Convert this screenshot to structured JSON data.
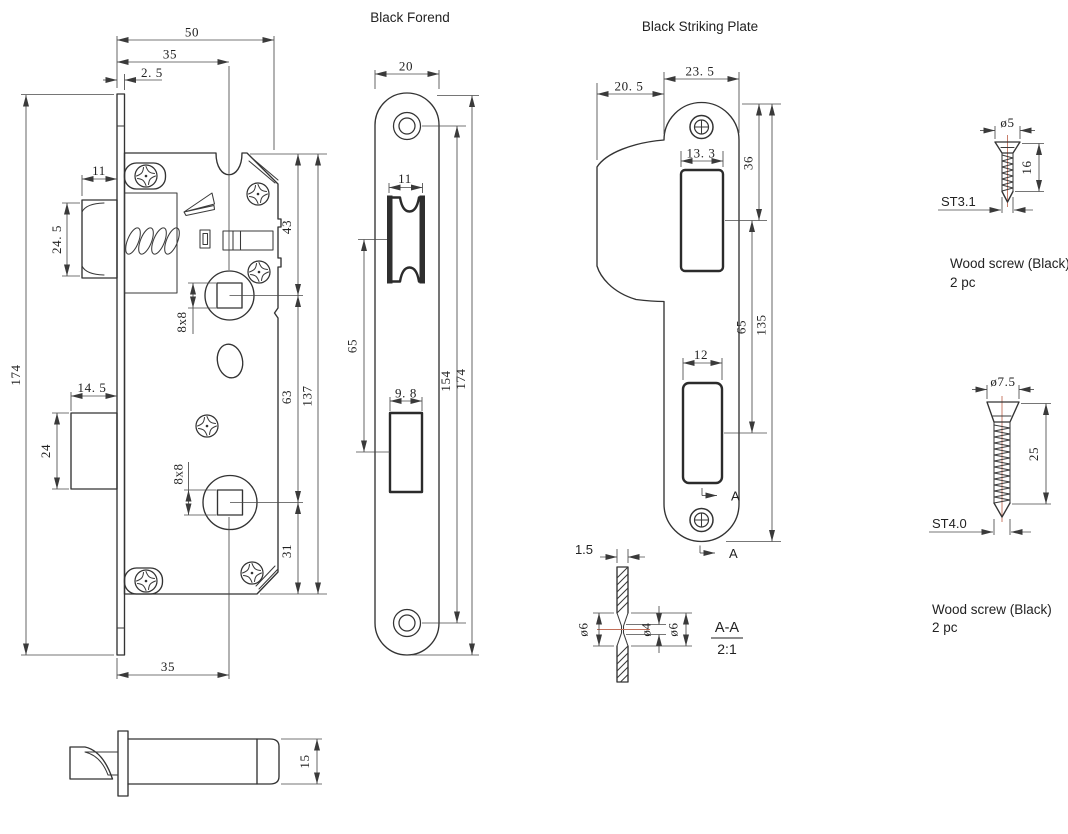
{
  "forend": {
    "title": "Black Forend",
    "dims": {
      "width": "20",
      "latch_cutout": "11",
      "cutout_spacing": "65",
      "bolt_cutout": "9. 8",
      "screw_spacing": "154",
      "length": "174"
    }
  },
  "striking_plate": {
    "title": "Black Striking Plate",
    "dims": {
      "width": "23. 5",
      "lip_width": "20. 5",
      "latch_cutout": "13. 3",
      "top_to_latch": "36",
      "cutout_spacing": "65",
      "length": "135",
      "bolt_cutout": "12"
    },
    "section_marker": "A"
  },
  "lock_body": {
    "dims": {
      "overall_width": "50",
      "backset": "35",
      "faceplate_thickness": "2. 5",
      "latch_width": "11",
      "latch_height": "24. 5",
      "overall_height": "174",
      "bolt_width": "14. 5",
      "bolt_height": "24",
      "spindle_hole": "8x8",
      "cylinder_hole": "8x8",
      "top_to_spindle": "43",
      "spindle_to_cylinder": "63",
      "body_height": "137",
      "cylinder_to_bottom": "31",
      "backset_bottom": "35"
    },
    "latch_detail_height": "15"
  },
  "section": {
    "thickness": "1.5",
    "outer_dia_left": "ø6",
    "inner_dia": "ø4",
    "outer_dia_right": "ø6",
    "label": "A-A",
    "scale": "2:1"
  },
  "screws": {
    "small": {
      "head_dia": "ø5",
      "length": "16",
      "thread": "ST3.1",
      "caption": "Wood screw (Black)",
      "qty": "2 pc"
    },
    "large": {
      "head_dia": "ø7.5",
      "length": "25",
      "thread": "ST4.0",
      "caption": "Wood screw (Black)",
      "qty": "2 pc"
    }
  },
  "colors": {
    "line": "#333333",
    "centerline": "#c2705a",
    "background": "#ffffff"
  }
}
